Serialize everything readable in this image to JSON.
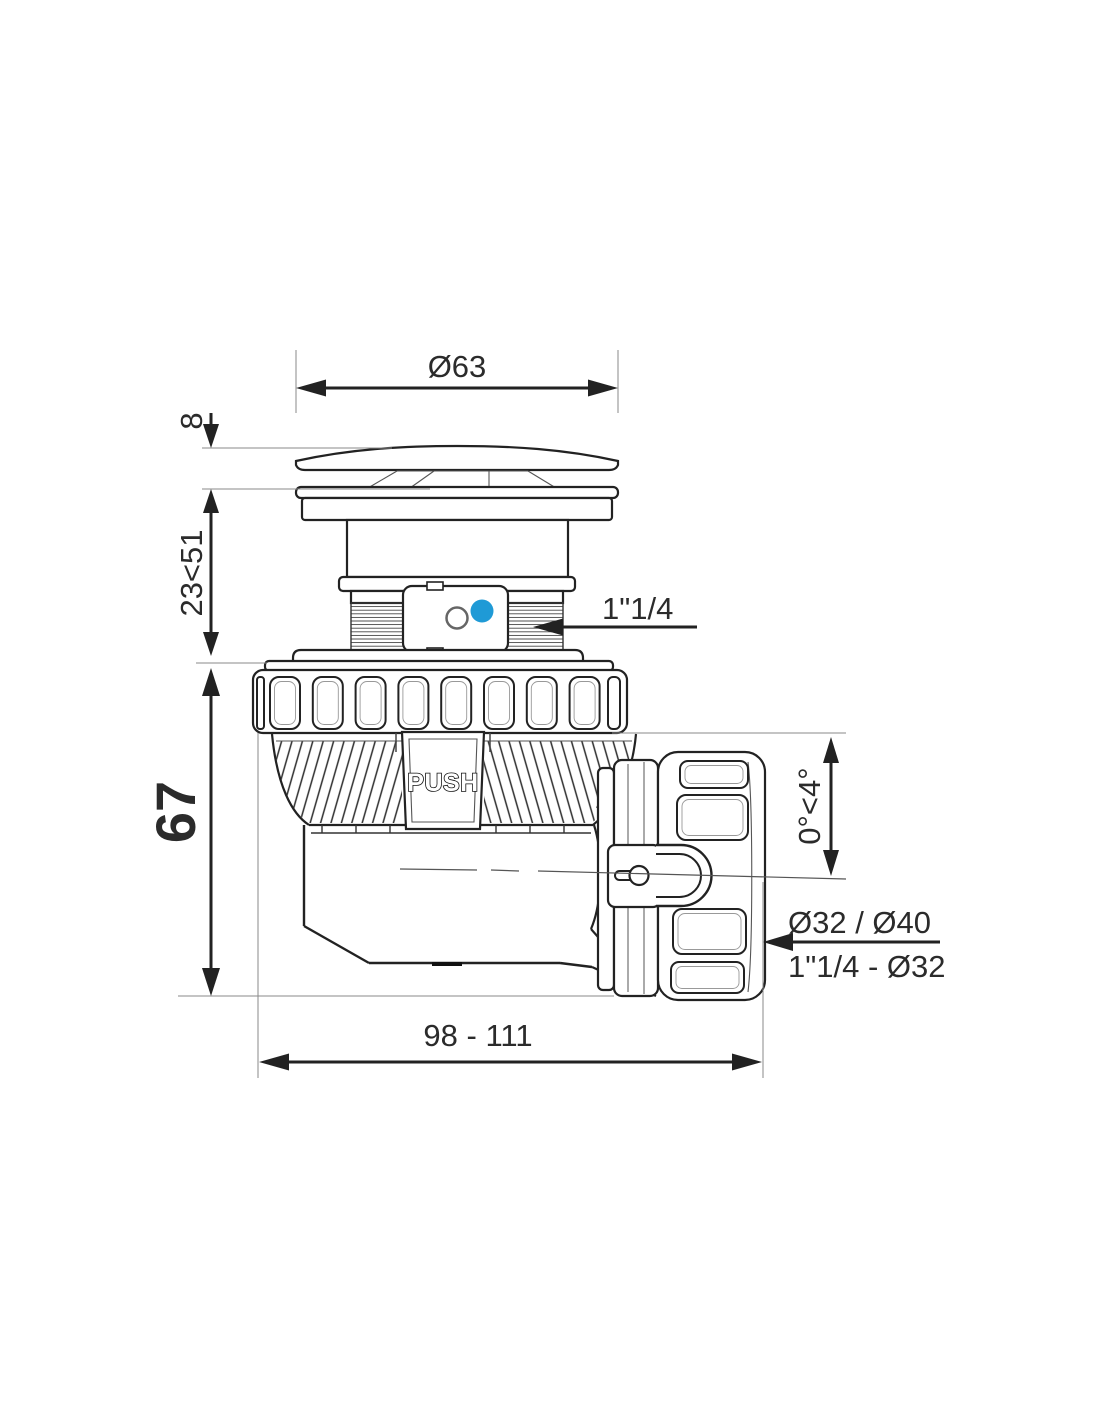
{
  "drawing": {
    "type": "technical-dimension-drawing",
    "subject": "push-open shower drain trap side view"
  },
  "dimensions": [
    {
      "name": "cap-diameter",
      "label": "Ø63"
    },
    {
      "name": "cap-height",
      "label": "8"
    },
    {
      "name": "adjustable-height",
      "label": "23<51"
    },
    {
      "name": "body-height",
      "label": "67"
    },
    {
      "name": "inlet-thread",
      "label": "1\"1/4"
    },
    {
      "name": "outlet-angle",
      "label": "0°<4°"
    },
    {
      "name": "outlet-diameters",
      "label": "Ø32 / Ø40"
    },
    {
      "name": "outlet-thread",
      "label": "1\"1/4 - Ø32"
    },
    {
      "name": "overall-length",
      "label": "98 - 111"
    }
  ],
  "body_labels": {
    "push": "PUSH"
  },
  "colors": {
    "line": "#222222",
    "dim_text": "#2b2b2b",
    "accent_blue": "#1f9ad6"
  }
}
